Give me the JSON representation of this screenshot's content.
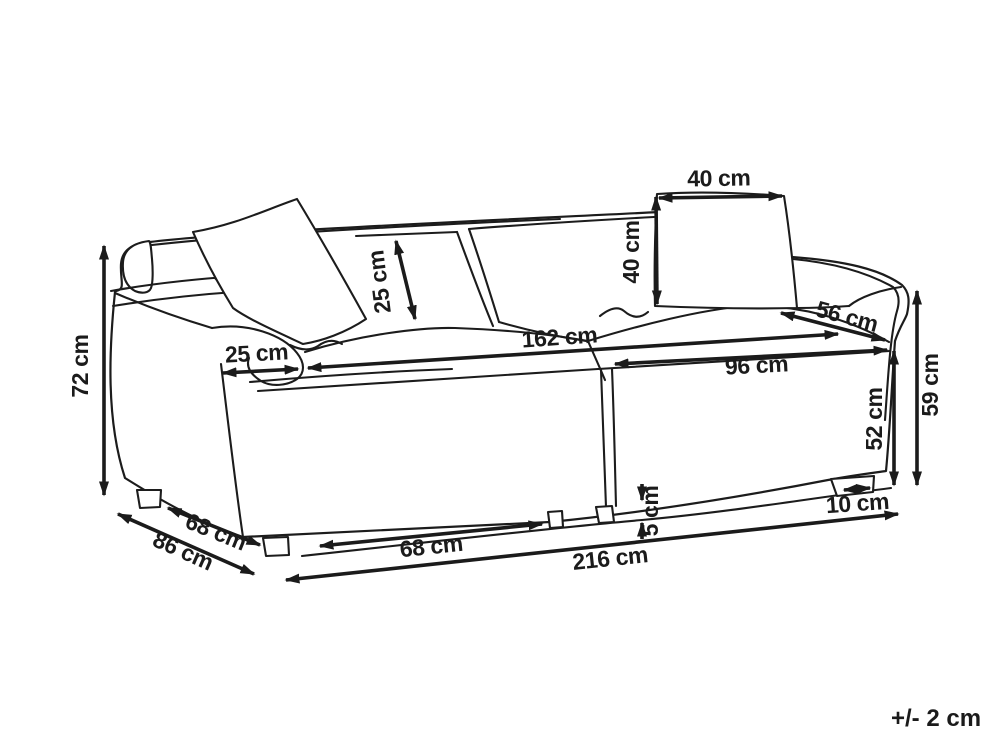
{
  "diagram": {
    "type": "sofa-dimension-drawing",
    "units": "cm",
    "labels": {
      "total_height": "72 cm",
      "armrest_width": "25 cm",
      "back_cushion_depth": "25 cm",
      "pillow_width": "40 cm",
      "pillow_height": "40 cm",
      "seat_depth": "56 cm",
      "seat_width_total": "162 cm",
      "seat_width_section": "96 cm",
      "side_height": "59 cm",
      "base_height": "52 cm",
      "leg_width": "10 cm",
      "leg_height": "5 cm",
      "leg_spacing": "68 cm",
      "frame_depth": "68 cm",
      "total_depth": "86 cm",
      "total_width": "216 cm",
      "tolerance": "+/- 2 cm"
    },
    "line_color": "#1b1b1b",
    "background_color": "#ffffff"
  }
}
